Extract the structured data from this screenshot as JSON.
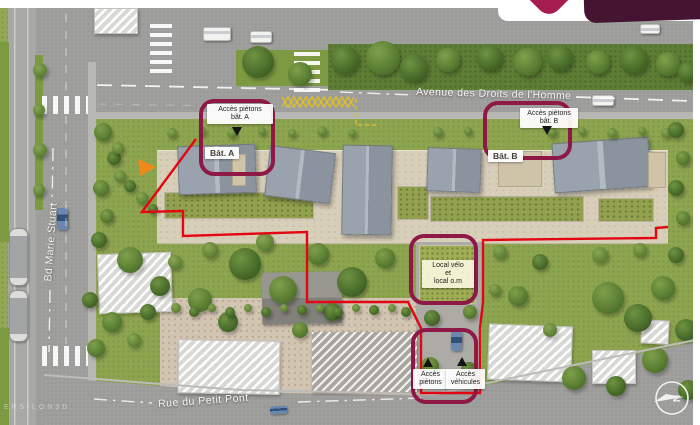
{
  "header": {
    "watermark": "EPSILON3D"
  },
  "streets": {
    "avenue": "Avenue des Droits de l'Homme",
    "boulevard": "Bd Marie Stuart",
    "rue": "Rue du Petit Pont"
  },
  "buildings": {
    "a_label": "Bât. A",
    "b_label": "Bât. B"
  },
  "callouts": {
    "pedestrian_a": {
      "line1": "Accès piétons",
      "line2": "bât. A"
    },
    "pedestrian_b": {
      "line1": "Accès piétons",
      "line2": "bât. B"
    },
    "bike_room": {
      "line1": "Local vélo",
      "line2": "et",
      "line3": "local o.m"
    },
    "pedestrian_access": {
      "line1": "Accès",
      "line2": "piétons"
    },
    "vehicle_access": {
      "line1": "Accès",
      "line2": "véhicules"
    }
  },
  "compass": {
    "north_letter": "N"
  },
  "colors": {
    "boundary_red": "#e30613",
    "highlight_magenta": "#8e1946",
    "logo_crimson": "#a81d4f",
    "logo_dark": "#451431"
  },
  "scene": {
    "boundary_path": "M196,139 L142,212 L183,211 L183,236 L307,232 L307,302 L408,302 L421,328 L421,393 L480,393 L480,328 L483,302 L483,240 L656,238 L656,228 L668,227",
    "zigzag_a": "282,107 288,97 294,107 300,97 306,107 312,97 318,107 324,97 330,107 336,97 342,107 348,97 354,107",
    "zigzag_b": "282,97 288,107 294,97 300,107 306,97 312,107 318,97 324,107 330,97 336,107 342,97 348,107 354,97",
    "bus_bay": "356,99 356,125 376,125",
    "rects": [
      {
        "n": "road-top",
        "x": 88,
        "y": 8,
        "w": 605,
        "h": 110,
        "c": "road"
      },
      {
        "n": "road-left",
        "x": 8,
        "y": 8,
        "w": 88,
        "h": 417,
        "c": "road"
      },
      {
        "n": "tram-lane",
        "x": 8,
        "y": 8,
        "w": 28,
        "h": 417,
        "c": "tram"
      },
      {
        "n": "grass-edge-left-top",
        "x": 0,
        "y": 42,
        "w": 9,
        "h": 200,
        "c": "grass-strip"
      },
      {
        "n": "grass-edge-left-bottom",
        "x": 0,
        "y": 328,
        "w": 9,
        "h": 97,
        "c": "grass-strip"
      },
      {
        "n": "median-left",
        "x": 35,
        "y": 55,
        "w": 8,
        "h": 155,
        "c": "grass-strip"
      },
      {
        "n": "sidewalk-left",
        "x": 88,
        "y": 62,
        "w": 8,
        "h": 363,
        "c": "sidewalk"
      },
      {
        "n": "road-stub-top-right",
        "x": 500,
        "y": 21,
        "w": 193,
        "h": 12,
        "c": "road"
      },
      {
        "n": "median-top",
        "x": 236,
        "y": 50,
        "w": 92,
        "h": 36,
        "c": "grass-strip"
      },
      {
        "n": "hedge-top",
        "x": 328,
        "y": 44,
        "w": 365,
        "h": 46,
        "c": "grass-dark"
      },
      {
        "n": "sidewalk-avenue",
        "x": 96,
        "y": 112,
        "w": 597,
        "h": 7,
        "c": "sidewalk"
      },
      {
        "n": "site-ground",
        "x": 96,
        "y": 119,
        "w": 597,
        "h": 286,
        "c": "grass"
      },
      {
        "n": "terrace-band",
        "x": 157,
        "y": 150,
        "w": 511,
        "h": 92,
        "c": "terrace"
      },
      {
        "n": "green-roof-a",
        "x": 164,
        "y": 192,
        "w": 148,
        "h": 25,
        "c": "groof"
      },
      {
        "n": "green-roof-b",
        "x": 430,
        "y": 196,
        "w": 152,
        "h": 24,
        "c": "groof"
      },
      {
        "n": "green-roof-b2",
        "x": 598,
        "y": 198,
        "w": 54,
        "h": 22,
        "c": "groof"
      },
      {
        "n": "passage-garden",
        "x": 397,
        "y": 186,
        "w": 30,
        "h": 32,
        "c": "groof"
      },
      {
        "n": "roof-a1",
        "x": 178,
        "y": 145,
        "w": 76,
        "h": 47,
        "c": "roof",
        "r": -2
      },
      {
        "n": "roof-a2",
        "x": 267,
        "y": 149,
        "w": 64,
        "h": 49,
        "c": "roof",
        "r": 7
      },
      {
        "n": "roof-a3",
        "x": 342,
        "y": 145,
        "w": 48,
        "h": 88,
        "c": "roof",
        "r": 1
      },
      {
        "n": "roof-b1",
        "x": 427,
        "y": 148,
        "w": 52,
        "h": 42,
        "c": "roof",
        "r": 2
      },
      {
        "n": "roof-b2",
        "x": 553,
        "y": 140,
        "w": 95,
        "h": 48,
        "c": "roof",
        "r": -4
      },
      {
        "n": "roof-deck-a",
        "x": 232,
        "y": 154,
        "w": 12,
        "h": 30,
        "c": "tan"
      },
      {
        "n": "roof-deck-b",
        "x": 498,
        "y": 151,
        "w": 42,
        "h": 34,
        "c": "tan"
      },
      {
        "n": "roof-deck-b2",
        "x": 648,
        "y": 152,
        "w": 16,
        "h": 34,
        "c": "tan"
      },
      {
        "n": "gravel-yard",
        "x": 160,
        "y": 298,
        "w": 258,
        "h": 102,
        "c": "gravel"
      },
      {
        "n": "driveway",
        "x": 416,
        "y": 242,
        "w": 66,
        "h": 158,
        "c": "concrete"
      },
      {
        "n": "bike-local-roof",
        "x": 419,
        "y": 245,
        "w": 55,
        "h": 57,
        "c": "groof2"
      },
      {
        "n": "road-bottom",
        "x": 44,
        "y": 335,
        "w": 656,
        "h": 90,
        "c": "road-bottom"
      },
      {
        "n": "house",
        "x": 98,
        "y": 253,
        "w": 72,
        "h": 58,
        "c": "hatch",
        "r": -2
      },
      {
        "n": "house",
        "x": 262,
        "y": 272,
        "w": 80,
        "h": 52,
        "c": "roofdark",
        "r": -1
      },
      {
        "n": "house",
        "x": 178,
        "y": 340,
        "w": 100,
        "h": 52,
        "c": "hatch",
        "r": 1
      },
      {
        "n": "house",
        "x": 312,
        "y": 332,
        "w": 105,
        "h": 60,
        "c": "hatchdark"
      },
      {
        "n": "house",
        "x": 488,
        "y": 325,
        "w": 82,
        "h": 54,
        "c": "hatch",
        "r": 2
      },
      {
        "n": "house",
        "x": 592,
        "y": 350,
        "w": 42,
        "h": 32,
        "c": "hatch"
      },
      {
        "n": "house",
        "x": 641,
        "y": 320,
        "w": 26,
        "h": 22,
        "c": "hatch",
        "r": 3
      },
      {
        "n": "platform-top-left",
        "x": 94,
        "y": 8,
        "w": 42,
        "h": 24,
        "c": "hatch"
      },
      {
        "n": "crosswalk",
        "x": 150,
        "y": 24,
        "w": 22,
        "h": 54,
        "c": "zebra-h"
      },
      {
        "n": "crosswalk",
        "x": 294,
        "y": 52,
        "w": 26,
        "h": 44,
        "c": "zebra-h"
      },
      {
        "n": "crosswalk",
        "x": 42,
        "y": 346,
        "w": 46,
        "h": 20,
        "c": "zebra-v"
      },
      {
        "n": "crosswalk",
        "x": 42,
        "y": 96,
        "w": 46,
        "h": 18,
        "c": "zebra-v"
      },
      {
        "n": "vehicle",
        "x": 203,
        "y": 27,
        "w": 26,
        "h": 12,
        "c": "car-white"
      },
      {
        "n": "vehicle",
        "x": 250,
        "y": 31,
        "w": 20,
        "h": 10,
        "c": "car-white"
      },
      {
        "n": "vehicle",
        "x": 592,
        "y": 95,
        "w": 20,
        "h": 9,
        "c": "car-white"
      },
      {
        "n": "vehicle",
        "x": 640,
        "y": 24,
        "w": 18,
        "h": 8,
        "c": "car-white"
      },
      {
        "n": "vehicle",
        "x": 57,
        "y": 208,
        "w": 11,
        "h": 22,
        "c": "car-blue"
      },
      {
        "n": "vehicle",
        "x": 270,
        "y": 406,
        "w": 17,
        "h": 8,
        "c": "car-blue",
        "r": -4
      },
      {
        "n": "vehicle",
        "x": 451,
        "y": 331,
        "w": 11,
        "h": 20,
        "c": "car-blue",
        "r": 2
      },
      {
        "n": "tram-vehicle",
        "x": 9,
        "y": 228,
        "w": 17,
        "h": 56,
        "c": "tram-car"
      },
      {
        "n": "tram-vehicle",
        "x": 9,
        "y": 290,
        "w": 17,
        "h": 50,
        "c": "tram-car"
      }
    ],
    "trees": [
      [
        258,
        62,
        16,
        "t2"
      ],
      [
        300,
        74,
        12,
        "t1"
      ],
      [
        345,
        60,
        14,
        "t2"
      ],
      [
        383,
        58,
        17,
        "t1"
      ],
      [
        414,
        68,
        14,
        "t2"
      ],
      [
        448,
        60,
        12,
        "t1"
      ],
      [
        490,
        58,
        13,
        "t2"
      ],
      [
        528,
        62,
        14,
        "t1"
      ],
      [
        560,
        58,
        13,
        "t2"
      ],
      [
        598,
        62,
        12,
        "t1"
      ],
      [
        634,
        60,
        14,
        "t2"
      ],
      [
        668,
        64,
        12,
        "t1"
      ],
      [
        688,
        72,
        10,
        "t2"
      ],
      [
        40,
        70,
        7,
        "t3"
      ],
      [
        39,
        110,
        6,
        "t3"
      ],
      [
        40,
        150,
        7,
        "t3"
      ],
      [
        39,
        190,
        6,
        "t3"
      ],
      [
        103,
        132,
        9,
        "t1"
      ],
      [
        114,
        158,
        7,
        "t2"
      ],
      [
        101,
        188,
        8,
        "t1"
      ],
      [
        120,
        176,
        6,
        "t3"
      ],
      [
        130,
        186,
        6,
        "t2"
      ],
      [
        142,
        198,
        6,
        "t3"
      ],
      [
        153,
        209,
        5,
        "t2"
      ],
      [
        118,
        148,
        6,
        "t3"
      ],
      [
        107,
        216,
        7,
        "t1"
      ],
      [
        99,
        240,
        8,
        "t2"
      ],
      [
        172,
        133,
        5,
        "t3"
      ],
      [
        202,
        131,
        4,
        "t3"
      ],
      [
        232,
        133,
        5,
        "t3"
      ],
      [
        262,
        131,
        4,
        "t3"
      ],
      [
        292,
        133,
        4,
        "t3"
      ],
      [
        322,
        131,
        5,
        "t3"
      ],
      [
        352,
        133,
        4,
        "t3"
      ],
      [
        438,
        132,
        5,
        "t3"
      ],
      [
        468,
        131,
        4,
        "t3"
      ],
      [
        552,
        132,
        5,
        "t3"
      ],
      [
        582,
        131,
        4,
        "t3"
      ],
      [
        612,
        133,
        5,
        "t3"
      ],
      [
        642,
        131,
        4,
        "t3"
      ],
      [
        666,
        133,
        5,
        "t3"
      ],
      [
        130,
        260,
        13,
        "t1"
      ],
      [
        160,
        286,
        10,
        "t2"
      ],
      [
        200,
        300,
        12,
        "t1"
      ],
      [
        245,
        264,
        16,
        "t2"
      ],
      [
        283,
        290,
        14,
        "t1"
      ],
      [
        228,
        322,
        10,
        "t2"
      ],
      [
        318,
        254,
        11,
        "t1"
      ],
      [
        352,
        282,
        15,
        "t2"
      ],
      [
        385,
        258,
        10,
        "t1"
      ],
      [
        332,
        312,
        9,
        "t2"
      ],
      [
        300,
        330,
        8,
        "t1"
      ],
      [
        265,
        242,
        9,
        "t3"
      ],
      [
        210,
        250,
        8,
        "t3"
      ],
      [
        175,
        262,
        7,
        "t3"
      ],
      [
        176,
        308,
        5,
        "t3"
      ],
      [
        194,
        312,
        5,
        "t2"
      ],
      [
        212,
        308,
        4,
        "t3"
      ],
      [
        230,
        312,
        5,
        "t2"
      ],
      [
        248,
        308,
        4,
        "t3"
      ],
      [
        266,
        312,
        5,
        "t2"
      ],
      [
        284,
        308,
        4,
        "t3"
      ],
      [
        302,
        310,
        5,
        "t2"
      ],
      [
        320,
        308,
        4,
        "t3"
      ],
      [
        338,
        312,
        5,
        "t2"
      ],
      [
        356,
        308,
        4,
        "t3"
      ],
      [
        374,
        310,
        5,
        "t2"
      ],
      [
        392,
        308,
        4,
        "t3"
      ],
      [
        406,
        312,
        5,
        "t2"
      ],
      [
        518,
        296,
        10,
        "t1"
      ],
      [
        540,
        262,
        8,
        "t2"
      ],
      [
        500,
        252,
        7,
        "t3"
      ],
      [
        608,
        298,
        16,
        "t1"
      ],
      [
        638,
        318,
        14,
        "t2"
      ],
      [
        663,
        288,
        12,
        "t1"
      ],
      [
        686,
        330,
        11,
        "t2"
      ],
      [
        574,
        378,
        12,
        "t1"
      ],
      [
        616,
        386,
        10,
        "t2"
      ],
      [
        655,
        360,
        13,
        "t1"
      ],
      [
        688,
        390,
        10,
        "t2"
      ],
      [
        600,
        255,
        8,
        "t3"
      ],
      [
        640,
        250,
        7,
        "t3"
      ],
      [
        676,
        255,
        8,
        "t2"
      ],
      [
        550,
        330,
        7,
        "t3"
      ],
      [
        495,
        290,
        6,
        "t3"
      ],
      [
        676,
        130,
        8,
        "t2"
      ],
      [
        683,
        158,
        7,
        "t1"
      ],
      [
        676,
        188,
        8,
        "t2"
      ],
      [
        683,
        218,
        7,
        "t1"
      ],
      [
        432,
        318,
        8,
        "t2"
      ],
      [
        470,
        312,
        7,
        "t1"
      ],
      [
        430,
        366,
        9,
        "t1"
      ],
      [
        469,
        370,
        8,
        "t2"
      ],
      [
        112,
        322,
        10,
        "t1"
      ],
      [
        148,
        312,
        8,
        "t2"
      ],
      [
        96,
        348,
        9,
        "t1"
      ],
      [
        134,
        340,
        7,
        "t3"
      ],
      [
        90,
        300,
        8,
        "t2"
      ]
    ]
  }
}
